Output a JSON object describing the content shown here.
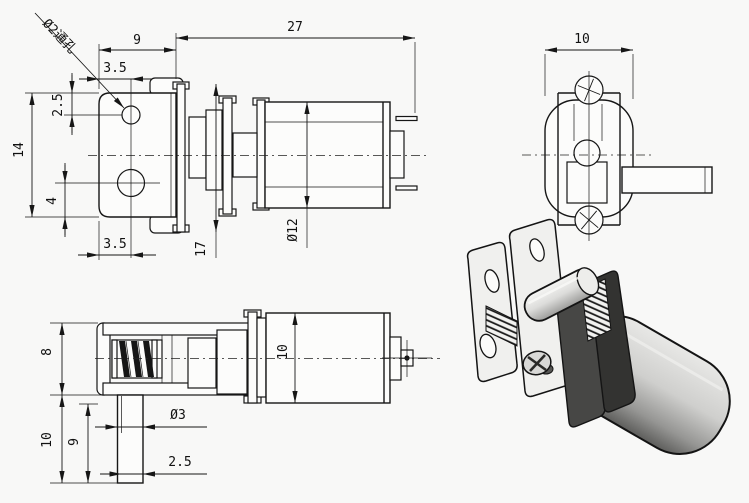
{
  "drawing": {
    "type": "engineering-drawing",
    "subject": "micro worm gear motor, three orthographic views and one isometric view",
    "colors": {
      "background": "#f8f8f7",
      "line": "#161616",
      "iso_plate": "#f0f0ee",
      "iso_gearbox_dark": "#3c3c3c",
      "iso_motor_light": "#e2e2e2",
      "iso_motor_shade": "#8d8d8d"
    }
  },
  "dims": {
    "front": {
      "bracket_width": "9",
      "total_length": "27",
      "hole_offset_top": "3.5",
      "hole_top_from_top": "2.5",
      "plate_height": "14",
      "hole_bottom_from_bottom": "4",
      "hole_offset_bottom": "3.5",
      "gearbox_height": "17",
      "motor_diameter": "Ø12",
      "through_hole_note": "Ø2通孔"
    },
    "end": {
      "body_width": "10"
    },
    "top": {
      "bracket_depth": "8",
      "shaft_length": "10",
      "flat_length": "9",
      "shaft_diameter": "Ø3",
      "flat_width": "2.5",
      "motor_width": "10"
    }
  }
}
